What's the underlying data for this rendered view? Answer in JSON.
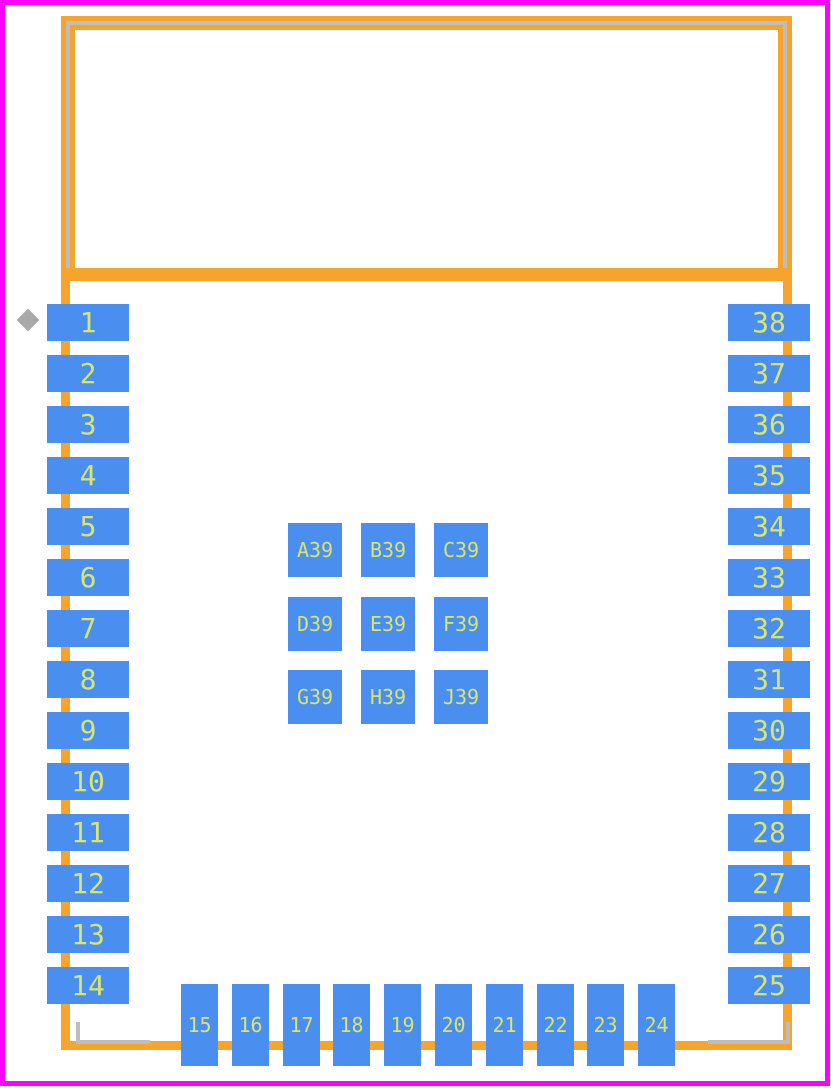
{
  "colors": {
    "courtyard_magenta": "#FF00FF",
    "silkscreen_orange": "#F7A42C",
    "body_gray": "#BDBDBD",
    "pad_blue": "#4A8FF0",
    "pad_label_lime": "#D9E56E",
    "marker_gray": "#A9A9A9",
    "background": "#FFFFFF"
  },
  "pads": {
    "left": [
      "1",
      "2",
      "3",
      "4",
      "5",
      "6",
      "7",
      "8",
      "9",
      "10",
      "11",
      "12",
      "13",
      "14"
    ],
    "right": [
      "38",
      "37",
      "36",
      "35",
      "34",
      "33",
      "32",
      "31",
      "30",
      "29",
      "28",
      "27",
      "26",
      "25"
    ],
    "bottom": [
      "15",
      "16",
      "17",
      "18",
      "19",
      "20",
      "21",
      "22",
      "23",
      "24"
    ],
    "center_rows": [
      [
        "A39",
        "B39",
        "C39"
      ],
      [
        "D39",
        "E39",
        "F39"
      ],
      [
        "G39",
        "H39",
        "J39"
      ]
    ]
  }
}
